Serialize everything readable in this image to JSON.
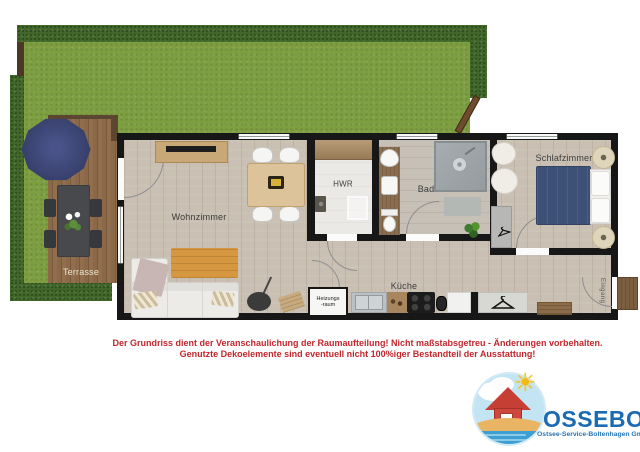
{
  "labels": {
    "terrasse": "Terrasse",
    "wohnzimmer": "Wohnzimmer",
    "hwr": "HWR",
    "bad": "Bad",
    "schlafzimmer": "Schlafzimmer",
    "kueche": "Küche",
    "heizung1": "Heizungs",
    "heizung2": "-raum",
    "eingang": "Eingang"
  },
  "disclaimer": {
    "line1": "Der Grundriss dient der Veranschaulichung der Raumaufteilung! Nicht maßstabsgetreu - Änderungen vorbehalten.",
    "line2": "Genutzte Dekoelemente sind eventuell nicht 100%iger Bestandteil der Ausstattung!"
  },
  "logo": {
    "name": "OSSEBO",
    "subtitle": "Ostsee-Service-Boltenhagen GmbH",
    "sun_glyph": "☀"
  },
  "colors": {
    "wall": "#171717",
    "lawn_green": "#7e9e42",
    "hedge_green": "#41682a",
    "deck_brown": "#8a6848",
    "floor_wood": "#c9bfb3",
    "accent_red": "#c2272d",
    "logo_blue": "#1a6bb2",
    "bed_blue": "#3d5177",
    "parasol_navy": "#39426f",
    "rug_orange": "#d5973f"
  }
}
